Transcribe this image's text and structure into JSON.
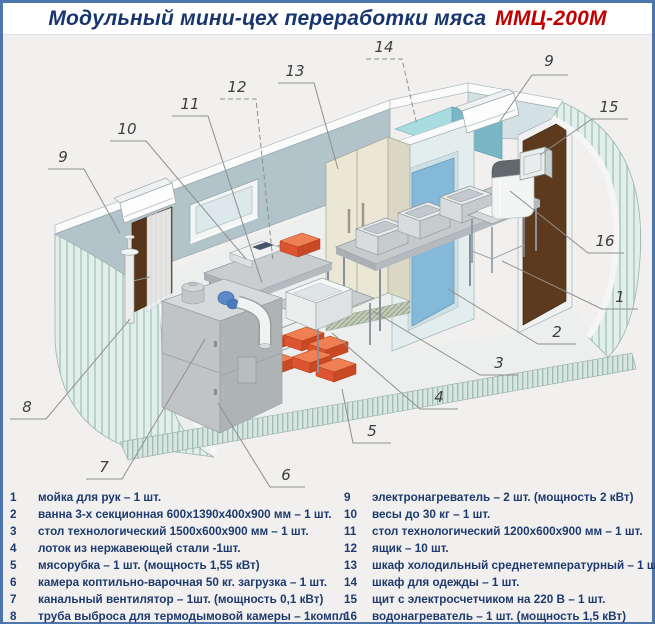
{
  "title": {
    "main": "Модульный мини-цех переработки мяса",
    "model": "ММЦ-200М"
  },
  "colors": {
    "frame_border": "#4d77ac",
    "title_text": "#17356e",
    "title_model": "#c00000",
    "legend_text": "#1e3a6e",
    "canvas_background": "#f1f0ee",
    "crate_orange": "#dd5530",
    "wall_blue_gray": "#b2c3ca"
  },
  "illustration": {
    "callouts": [
      {
        "id": "9-left",
        "label": "9"
      },
      {
        "id": "10",
        "label": "10"
      },
      {
        "id": "11",
        "label": "11"
      },
      {
        "id": "12",
        "label": "12"
      },
      {
        "id": "13",
        "label": "13"
      },
      {
        "id": "14",
        "label": "14"
      },
      {
        "id": "9-right",
        "label": "9"
      },
      {
        "id": "15",
        "label": "15"
      },
      {
        "id": "16",
        "label": "16"
      },
      {
        "id": "1",
        "label": "1"
      },
      {
        "id": "2",
        "label": "2"
      },
      {
        "id": "3",
        "label": "3"
      },
      {
        "id": "4",
        "label": "4"
      },
      {
        "id": "5",
        "label": "5"
      },
      {
        "id": "6",
        "label": "6"
      },
      {
        "id": "7",
        "label": "7"
      },
      {
        "id": "8",
        "label": "8"
      }
    ]
  },
  "legend": {
    "left": [
      {
        "num": "1",
        "text": "мойка для рук – 1 шт."
      },
      {
        "num": "2",
        "text": "ванна 3-х секционная 600х1390х400х900 мм – 1 шт."
      },
      {
        "num": "3",
        "text": "стол технологический 1500х600х900 мм – 1 шт."
      },
      {
        "num": "4",
        "text": "лоток из нержавеющей стали -1шт."
      },
      {
        "num": "5",
        "text": "мясорубка – 1 шт. (мощность 1,55 кВт)"
      },
      {
        "num": "6",
        "text": "камера коптильно-варочная 50 кг. загрузка – 1 шт."
      },
      {
        "num": "7",
        "text": "канальный вентилятор – 1шт. (мощность 0,1 кВт)"
      },
      {
        "num": "8",
        "text": "труба выброса для термодымовой камеры – 1компл."
      }
    ],
    "right": [
      {
        "num": "9",
        "text": "электронагреватель – 2 шт. (мощность 2 кВт)"
      },
      {
        "num": "10",
        "text": "весы до 30 кг – 1 шт."
      },
      {
        "num": "11",
        "text": "стол технологический 1200х600х900 мм – 1 шт."
      },
      {
        "num": "12",
        "text": "ящик – 10 шт."
      },
      {
        "num": "13",
        "text": "шкаф холодильный среднетемпературный – 1 шт."
      },
      {
        "num": "14",
        "text": "шкаф для одежды – 1 шт."
      },
      {
        "num": "15",
        "text": "щит с электросчетчиком на 220 В – 1 шт."
      },
      {
        "num": "16",
        "text": "водонагреватель – 1 шт. (мощность 1,5 кВт)"
      }
    ]
  }
}
